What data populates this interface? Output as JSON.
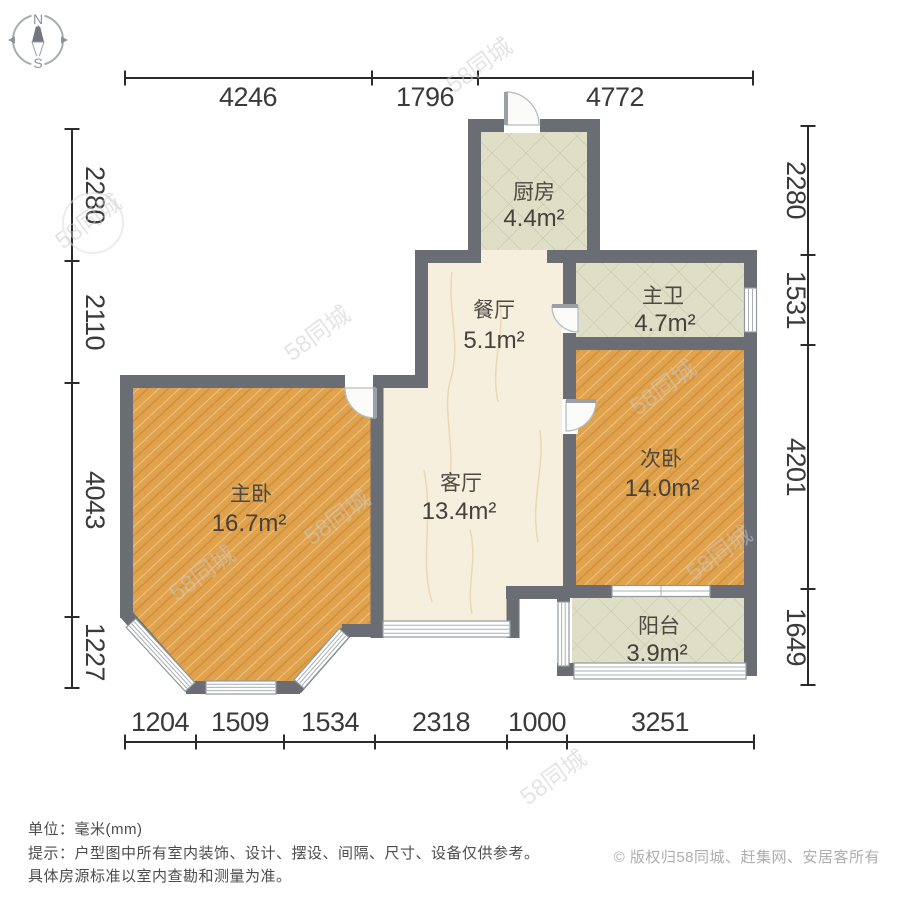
{
  "compass": {
    "north": "N",
    "south": "S"
  },
  "dims": {
    "top": [
      "4246",
      "1796",
      "4772"
    ],
    "left": [
      "2280",
      "2110",
      "4043",
      "1227"
    ],
    "right": [
      "2280",
      "1531",
      "4201",
      "1649"
    ],
    "bottom": [
      "1204",
      "1509",
      "1534",
      "2318",
      "1000",
      "3251"
    ]
  },
  "rooms": {
    "kitchen": {
      "name": "厨房",
      "area": "4.4m²"
    },
    "dining": {
      "name": "餐厅",
      "area": "5.1m²"
    },
    "master_bath": {
      "name": "主卫",
      "area": "4.7m²"
    },
    "living": {
      "name": "客厅",
      "area": "13.4m²"
    },
    "master_bedroom": {
      "name": "主卧",
      "area": "16.7m²"
    },
    "second_bedroom": {
      "name": "次卧",
      "area": "14.0m²"
    },
    "balcony": {
      "name": "阳台",
      "area": "3.9m²"
    }
  },
  "footer": {
    "unit": "单位：毫米(mm)",
    "tip_line1": "提示：户型图中所有室内装饰、设计、摆设、间隔、尺寸、设备仅供参考。",
    "tip_line2": "具体房源标准以室内查勘和测量为准。",
    "copyright": "© 版权归58同城、赶集网、安居客所有"
  },
  "watermark": {
    "text": "58同城"
  },
  "colors": {
    "wall": "#6a6e74",
    "wood_floor": "#e0a24c",
    "tile_floor": "#dfdec6",
    "marble_floor": "#f7efdd",
    "dim_line": "#2b2b2b"
  }
}
